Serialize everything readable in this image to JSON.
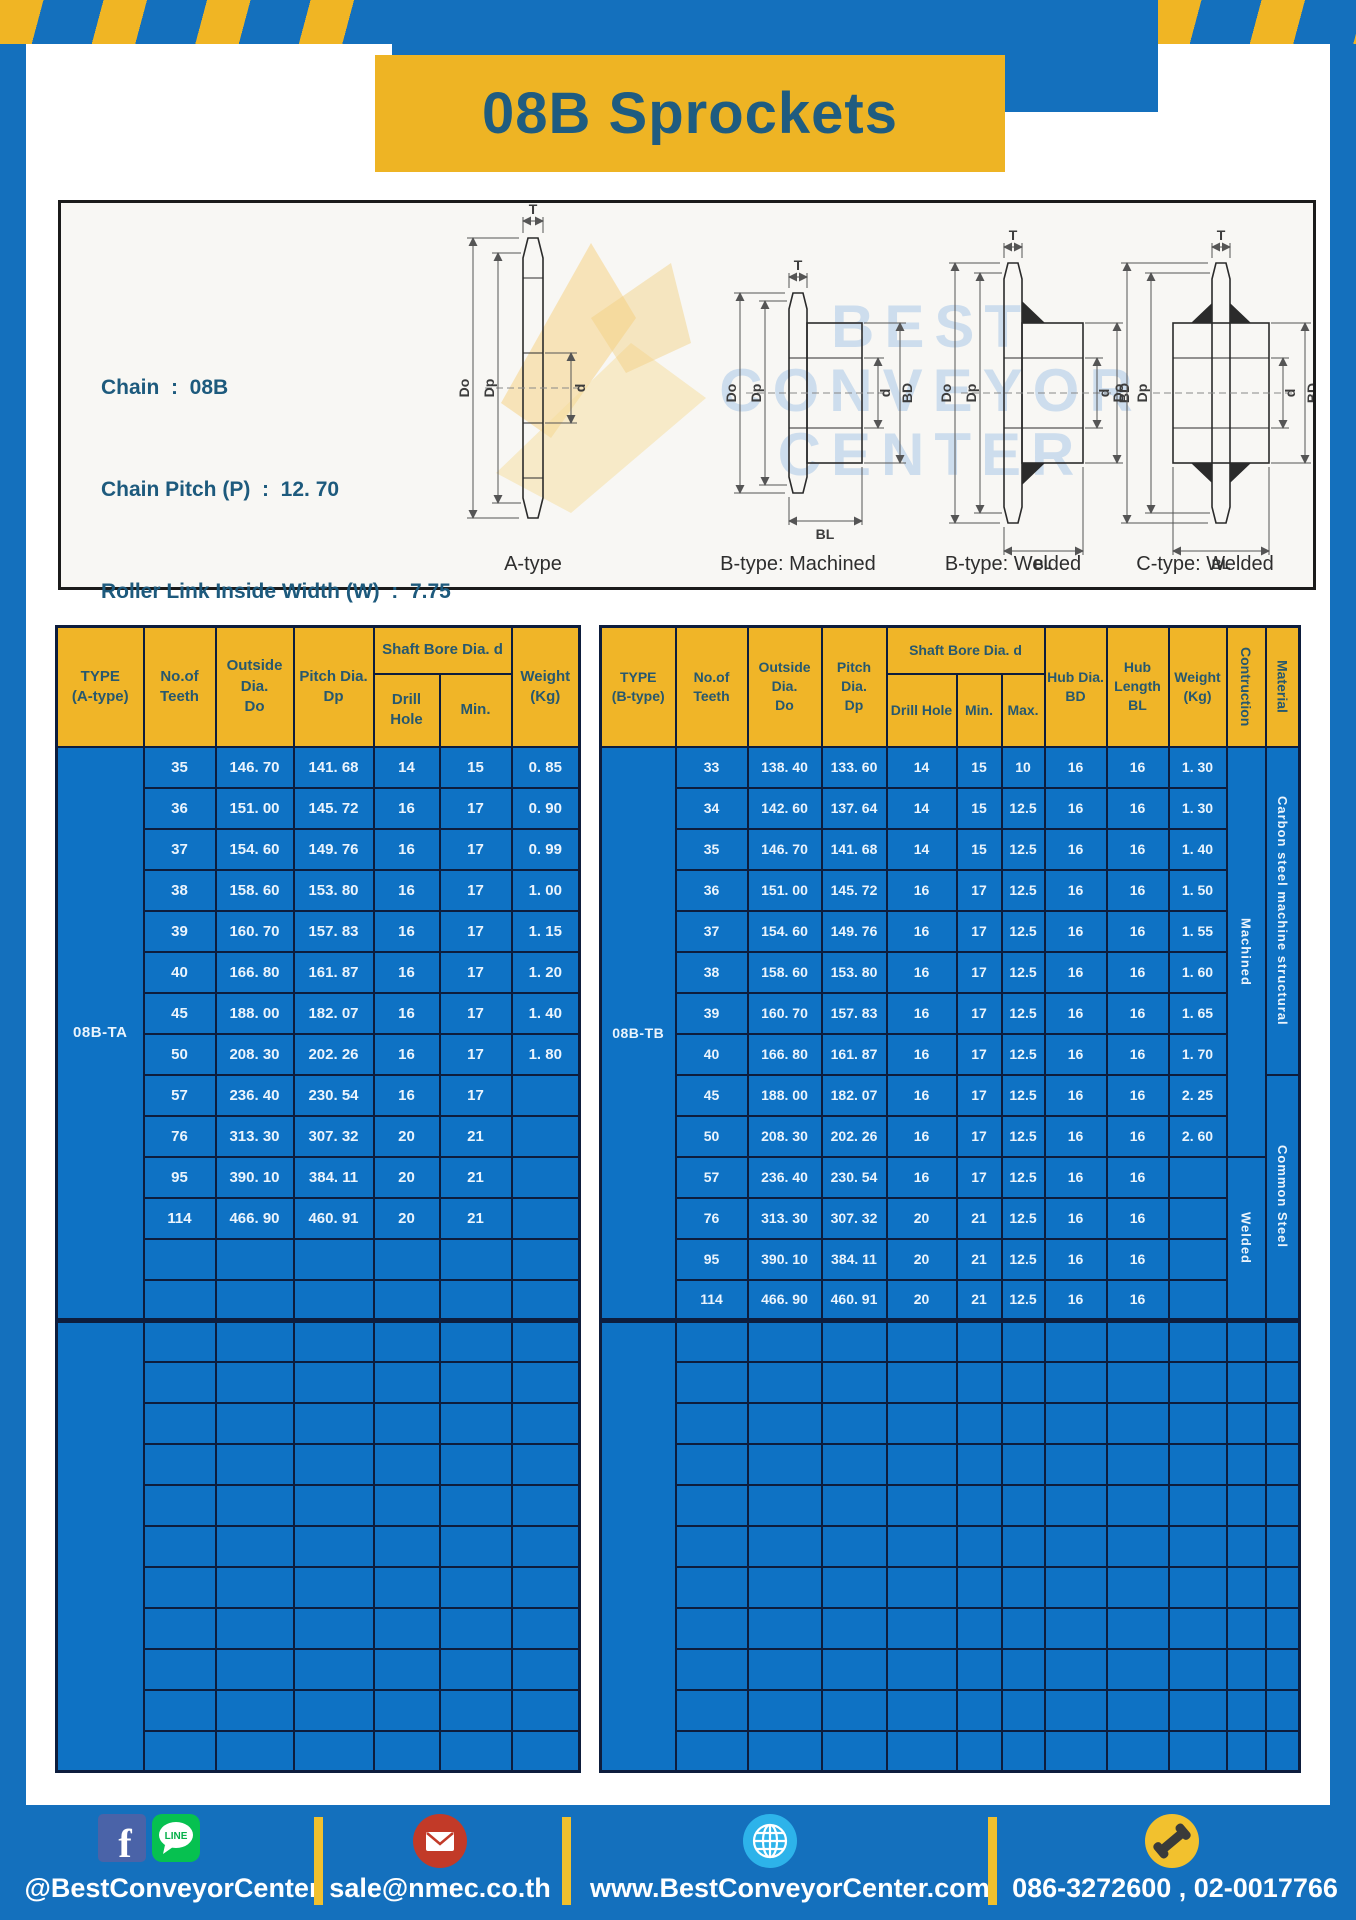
{
  "title": "08B Sprockets",
  "specs": [
    "Chain  :  08B",
    "Chain Pitch (P)  :  12. 70",
    "Roller Link Inside Width (W)  :  7.75",
    "Roller Diameter (Dr)  : 8.51",
    "Teeth Width (T)  :  7.2"
  ],
  "diagram": {
    "watermark": [
      "BEST",
      "CONVEYOR",
      "CENTER"
    ],
    "dims": {
      "t": "T",
      "do": "Do",
      "dp": "Dp",
      "d": "d",
      "bd": "BD",
      "bl": "BL"
    },
    "drawings": [
      {
        "caption": "A-type"
      },
      {
        "caption": "B-type: Machined"
      },
      {
        "caption": "B-type: Welded"
      },
      {
        "caption": "C-type: Welded"
      }
    ]
  },
  "table_a": {
    "type_label": "08B-TA",
    "headers": {
      "type1": "TYPE",
      "type2": "(A-type)",
      "teeth1": "No.of",
      "teeth2": "Teeth",
      "out1": "Outside",
      "out2": "Dia.",
      "out3": "Do",
      "pitch1": "Pitch Dia.",
      "pitch2": "Dp",
      "shaft": "Shaft Bore Dia. d",
      "drill": "Drill Hole",
      "min": "Min.",
      "w1": "Weight",
      "w2": "(Kg)"
    },
    "rows": [
      [
        "35",
        "146. 70",
        "141. 68",
        "14",
        "15",
        "0. 85"
      ],
      [
        "36",
        "151. 00",
        "145. 72",
        "16",
        "17",
        "0. 90"
      ],
      [
        "37",
        "154. 60",
        "149. 76",
        "16",
        "17",
        "0. 99"
      ],
      [
        "38",
        "158. 60",
        "153. 80",
        "16",
        "17",
        "1. 00"
      ],
      [
        "39",
        "160. 70",
        "157. 83",
        "16",
        "17",
        "1. 15"
      ],
      [
        "40",
        "166. 80",
        "161. 87",
        "16",
        "17",
        "1. 20"
      ],
      [
        "45",
        "188. 00",
        "182. 07",
        "16",
        "17",
        "1. 40"
      ],
      [
        "50",
        "208. 30",
        "202. 26",
        "16",
        "17",
        "1. 80"
      ],
      [
        "57",
        "236. 40",
        "230. 54",
        "16",
        "17",
        ""
      ],
      [
        "76",
        "313. 30",
        "307. 32",
        "20",
        "21",
        ""
      ],
      [
        "95",
        "390. 10",
        "384. 11",
        "20",
        "21",
        ""
      ],
      [
        "114",
        "466. 90",
        "460. 91",
        "20",
        "21",
        ""
      ]
    ],
    "section1_rows": 14,
    "section2_rows": 11
  },
  "table_b": {
    "type_label": "08B-TB",
    "headers": {
      "type1": "TYPE",
      "type2": "(B-type)",
      "teeth1": "No.of",
      "teeth2": "Teeth",
      "out1": "Outside",
      "out2": "Dia.",
      "out3": "Do",
      "pitch1": "Pitch Dia.",
      "pitch2": "Dp",
      "shaft": "Shaft Bore Dia. d",
      "drill": "Drill Hole",
      "min": "Min.",
      "max": "Max.",
      "hd1": "Hub Dia.",
      "hd2": "BD",
      "hl1": "Hub",
      "hl2": "Length",
      "hl3": "BL",
      "w1": "Weight",
      "w2": "(Kg)",
      "cons": "Contruction",
      "mat": "Material"
    },
    "rows": [
      [
        "33",
        "138. 40",
        "133. 60",
        "14",
        "15",
        "10",
        "16",
        "16",
        "1. 30"
      ],
      [
        "34",
        "142. 60",
        "137. 64",
        "14",
        "15",
        "12.5",
        "16",
        "16",
        "1. 30"
      ],
      [
        "35",
        "146. 70",
        "141. 68",
        "14",
        "15",
        "12.5",
        "16",
        "16",
        "1. 40"
      ],
      [
        "36",
        "151. 00",
        "145. 72",
        "16",
        "17",
        "12.5",
        "16",
        "16",
        "1. 50"
      ],
      [
        "37",
        "154. 60",
        "149. 76",
        "16",
        "17",
        "12.5",
        "16",
        "16",
        "1. 55"
      ],
      [
        "38",
        "158. 60",
        "153. 80",
        "16",
        "17",
        "12.5",
        "16",
        "16",
        "1. 60"
      ],
      [
        "39",
        "160. 70",
        "157. 83",
        "16",
        "17",
        "12.5",
        "16",
        "16",
        "1. 65"
      ],
      [
        "40",
        "166. 80",
        "161. 87",
        "16",
        "17",
        "12.5",
        "16",
        "16",
        "1. 70"
      ],
      [
        "45",
        "188. 00",
        "182. 07",
        "16",
        "17",
        "12.5",
        "16",
        "16",
        "2. 25"
      ],
      [
        "50",
        "208. 30",
        "202. 26",
        "16",
        "17",
        "12.5",
        "16",
        "16",
        "2. 60"
      ],
      [
        "57",
        "236. 40",
        "230. 54",
        "16",
        "17",
        "12.5",
        "16",
        "16",
        ""
      ],
      [
        "76",
        "313. 30",
        "307. 32",
        "20",
        "21",
        "12.5",
        "16",
        "16",
        ""
      ],
      [
        "95",
        "390. 10",
        "384. 11",
        "20",
        "21",
        "12.5",
        "16",
        "16",
        ""
      ],
      [
        "114",
        "466. 90",
        "460. 91",
        "20",
        "21",
        "12.5",
        "16",
        "16",
        ""
      ]
    ],
    "constructions": [
      {
        "label": "Machined",
        "rows": 10
      },
      {
        "label": "Welded",
        "rows": 4
      }
    ],
    "materials": [
      {
        "label": "Carbon steel  machine structural",
        "rows": 8
      },
      {
        "label": "Common  Steel",
        "rows": 6
      }
    ],
    "section1_rows": 14,
    "section2_rows": 11
  },
  "footer": {
    "facebook_glyph": "f",
    "line_label": "LINE",
    "social_handle": "@BestConveyorCenter",
    "email": "sale@nmec.co.th",
    "website": "www.BestConveyorCenter.com",
    "phones": "086-3272600 , 02-0017766"
  },
  "colors": {
    "frame_blue": "#1470bd",
    "hazard_yellow": "#f0b524",
    "header_yellow": "#f0b528",
    "table_blue": "#0e72c4",
    "grid_navy": "#0d1d3d",
    "title_text": "#1f5c80"
  }
}
